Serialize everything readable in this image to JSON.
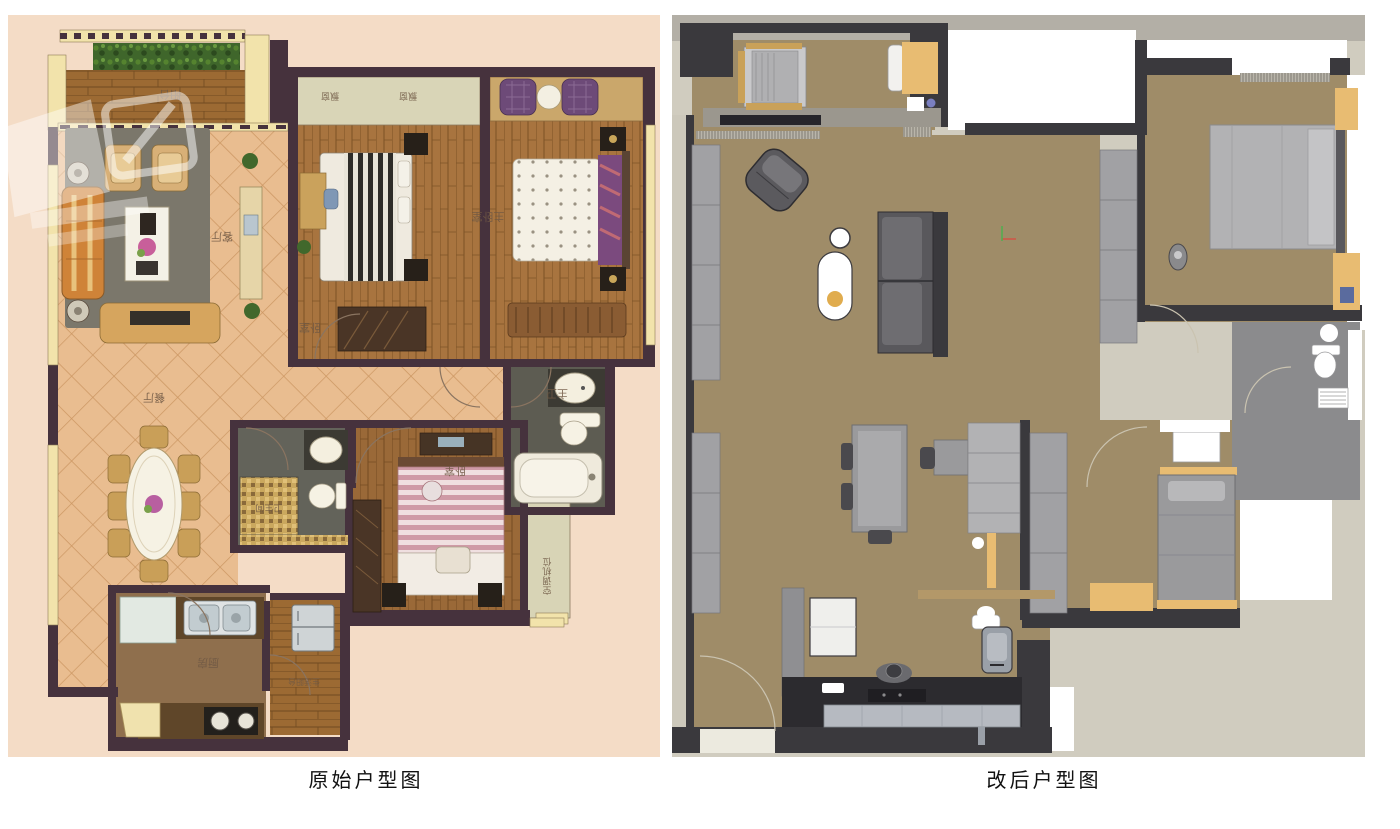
{
  "captions": {
    "left": "原始户型图",
    "right": "改后户型图"
  },
  "left_plan": {
    "labels": {
      "balcony": "阳台",
      "bay_window_1": "飘窗",
      "bay_window_2": "飘窗",
      "living_room": "客厅",
      "dining_room": "餐厅",
      "bedroom_top": "卧室",
      "master_bedroom": "主卧室",
      "master_bathroom": "主卫",
      "bathroom": "卫生间",
      "bedroom_bottom": "卧室",
      "kitchen": "厨房",
      "utility_balcony": "生活阳台",
      "ac_platform": "空调机位"
    },
    "colors": {
      "background": "#f4dcc6",
      "tile_floor": "#e9bd90",
      "wood_floor": "#a8743f",
      "wall": "#46323d",
      "window_sill": "#f2e3ab",
      "bath_floor": "#5d5c52",
      "hedge": "#3f662b",
      "rug": "#7b776b",
      "sofa": "#cf8338"
    }
  },
  "right_plan": {
    "labels": {},
    "colors": {
      "page": "#d0ccbf",
      "floor": "#9f8c68",
      "wall": "#3a393d",
      "furniture_light": "#b2b2b4",
      "furniture_dark": "#59585c",
      "accent_yellow": "#e8bc72",
      "bath_floor": "#8b8b8d",
      "counter": "#b6bac1"
    }
  }
}
